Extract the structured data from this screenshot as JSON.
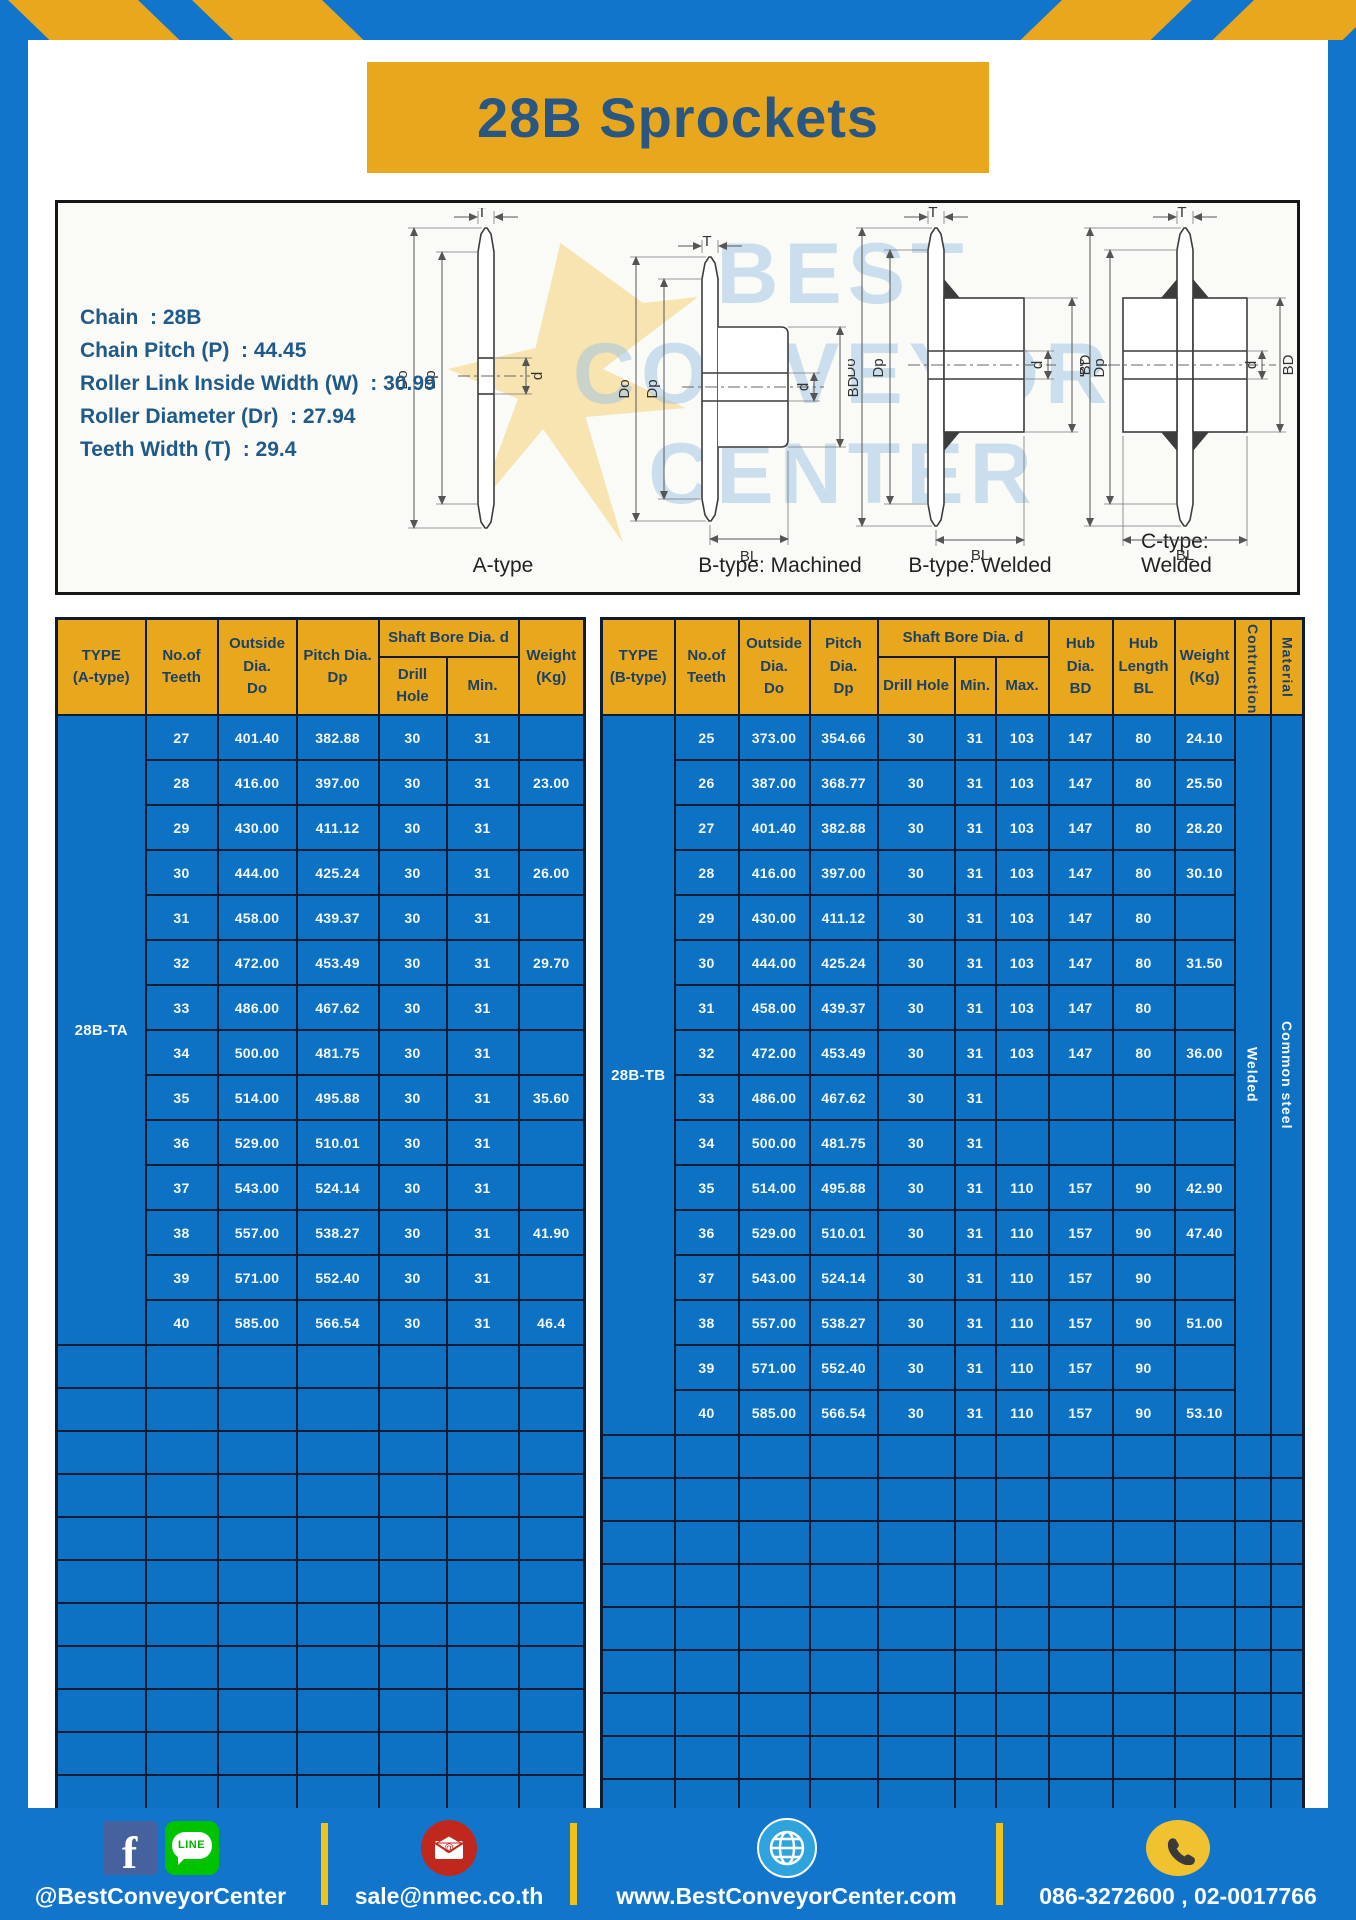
{
  "page": {
    "title": "28B Sprockets"
  },
  "colors": {
    "frame_blue": "#1176CB",
    "table_blue": "#0E72C4",
    "gold": "#E9A71E",
    "grid": "#0D1B33",
    "navy_text": "#1B4166",
    "footer_yellow": "#F1C318"
  },
  "specs": {
    "lines": [
      "Chain  : 28B",
      "Chain Pitch (P)  : 44.45",
      "Roller Link Inside Width (W)  : 30.99",
      "Roller Diameter (Dr)  : 27.94",
      "Teeth Width (T)  : 29.4"
    ]
  },
  "diagram": {
    "captions": [
      "A-type",
      "B-type: Machined",
      "B-type: Welded",
      "C-type: Welded"
    ],
    "labels": {
      "t": "T",
      "do_label": "Do",
      "dp": "Dp",
      "d": "d",
      "bd": "BD",
      "bl": "BL"
    },
    "watermark": [
      "BEST",
      "CONVEYOR",
      "CENTER"
    ]
  },
  "tables": {
    "left": {
      "type_label": "28B-TA",
      "headers": {
        "type": "TYPE\n(A-type)",
        "teeth": "No.of\nTeeth",
        "outside": "Outside\nDia.\nDo",
        "pitch": "Pitch Dia.\nDp",
        "shaft_bore": "Shaft Bore Dia. d",
        "drill_hole": "Drill Hole",
        "min": "Min.",
        "weight": "Weight\n(Kg)"
      },
      "rows": [
        [
          "27",
          "401.40",
          "382.88",
          "30",
          "31",
          ""
        ],
        [
          "28",
          "416.00",
          "397.00",
          "30",
          "31",
          "23.00"
        ],
        [
          "29",
          "430.00",
          "411.12",
          "30",
          "31",
          ""
        ],
        [
          "30",
          "444.00",
          "425.24",
          "30",
          "31",
          "26.00"
        ],
        [
          "31",
          "458.00",
          "439.37",
          "30",
          "31",
          ""
        ],
        [
          "32",
          "472.00",
          "453.49",
          "30",
          "31",
          "29.70"
        ],
        [
          "33",
          "486.00",
          "467.62",
          "30",
          "31",
          ""
        ],
        [
          "34",
          "500.00",
          "481.75",
          "30",
          "31",
          ""
        ],
        [
          "35",
          "514.00",
          "495.88",
          "30",
          "31",
          "35.60"
        ],
        [
          "36",
          "529.00",
          "510.01",
          "30",
          "31",
          ""
        ],
        [
          "37",
          "543.00",
          "524.14",
          "30",
          "31",
          ""
        ],
        [
          "38",
          "557.00",
          "538.27",
          "30",
          "31",
          "41.90"
        ],
        [
          "39",
          "571.00",
          "552.40",
          "30",
          "31",
          ""
        ],
        [
          "40",
          "585.00",
          "566.54",
          "30",
          "31",
          "46.4"
        ]
      ],
      "empty_rows": 11
    },
    "right": {
      "type_label": "28B-TB",
      "construction": "Welded",
      "material": "Common steel",
      "headers": {
        "type": "TYPE\n(B-type)",
        "teeth": "No.of\nTeeth",
        "outside": "Outside\nDia.\nDo",
        "pitch": "Pitch Dia.\nDp",
        "shaft_bore": "Shaft Bore Dia. d",
        "drill_hole": "Drill Hole",
        "min": "Min.",
        "max": "Max.",
        "hub_dia": "Hub Dia.\nBD",
        "hub_length": "Hub\nLength\nBL",
        "weight": "Weight\n(Kg)",
        "construction": "Contruction",
        "material": "Material"
      },
      "rows": [
        [
          "25",
          "373.00",
          "354.66",
          "30",
          "31",
          "103",
          "147",
          "80",
          "24.10"
        ],
        [
          "26",
          "387.00",
          "368.77",
          "30",
          "31",
          "103",
          "147",
          "80",
          "25.50"
        ],
        [
          "27",
          "401.40",
          "382.88",
          "30",
          "31",
          "103",
          "147",
          "80",
          "28.20"
        ],
        [
          "28",
          "416.00",
          "397.00",
          "30",
          "31",
          "103",
          "147",
          "80",
          "30.10"
        ],
        [
          "29",
          "430.00",
          "411.12",
          "30",
          "31",
          "103",
          "147",
          "80",
          ""
        ],
        [
          "30",
          "444.00",
          "425.24",
          "30",
          "31",
          "103",
          "147",
          "80",
          "31.50"
        ],
        [
          "31",
          "458.00",
          "439.37",
          "30",
          "31",
          "103",
          "147",
          "80",
          ""
        ],
        [
          "32",
          "472.00",
          "453.49",
          "30",
          "31",
          "103",
          "147",
          "80",
          "36.00"
        ],
        [
          "33",
          "486.00",
          "467.62",
          "30",
          "31",
          "",
          "",
          "",
          ""
        ],
        [
          "34",
          "500.00",
          "481.75",
          "30",
          "31",
          "",
          "",
          "",
          ""
        ],
        [
          "35",
          "514.00",
          "495.88",
          "30",
          "31",
          "110",
          "157",
          "90",
          "42.90"
        ],
        [
          "36",
          "529.00",
          "510.01",
          "30",
          "31",
          "110",
          "157",
          "90",
          "47.40"
        ],
        [
          "37",
          "543.00",
          "524.14",
          "30",
          "31",
          "110",
          "157",
          "90",
          ""
        ],
        [
          "38",
          "557.00",
          "538.27",
          "30",
          "31",
          "110",
          "157",
          "90",
          "51.00"
        ],
        [
          "39",
          "571.00",
          "552.40",
          "30",
          "31",
          "110",
          "157",
          "90",
          ""
        ],
        [
          "40",
          "585.00",
          "566.54",
          "30",
          "31",
          "110",
          "157",
          "90",
          "53.10"
        ]
      ],
      "empty_rows": 9
    }
  },
  "footer": {
    "facebook_letter": "f",
    "line_label": "LINE",
    "social_handle": "@BestConveyorCenter",
    "email": "sale@nmec.co.th",
    "website": "www.BestConveyorCenter.com",
    "phones": "086-3272600 , 02-0017766"
  }
}
